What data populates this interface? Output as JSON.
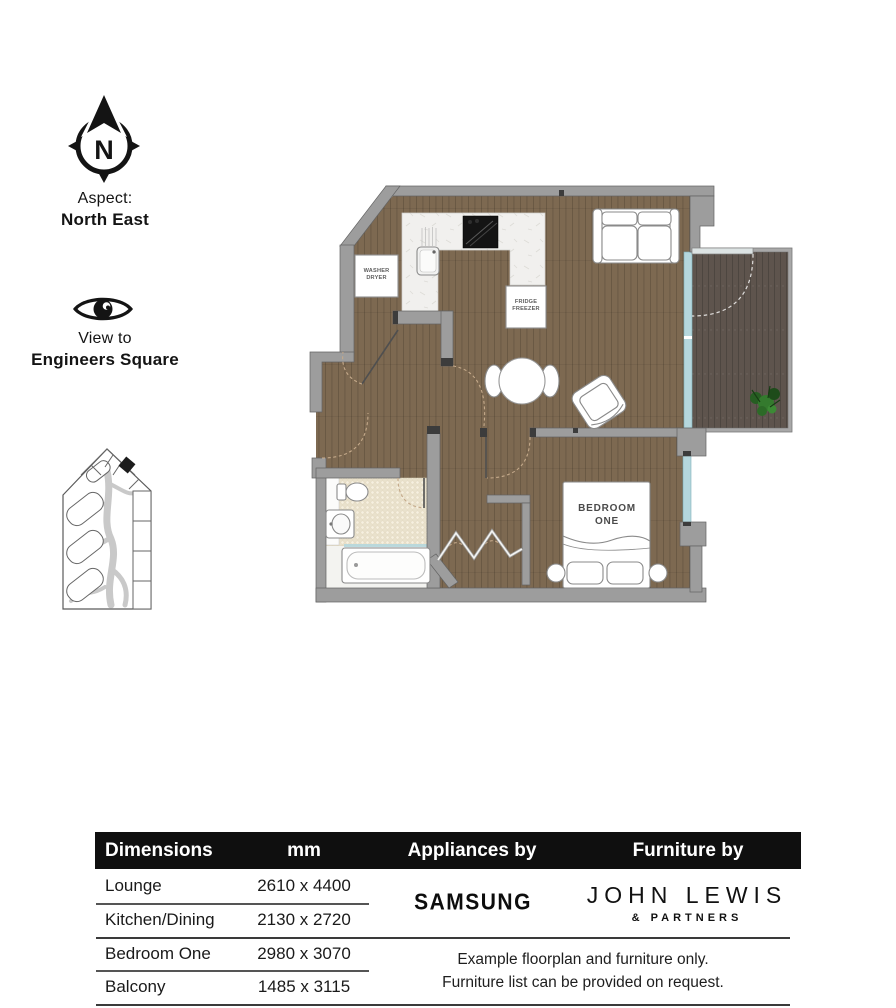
{
  "compass": {
    "north_letter": "N"
  },
  "aspect": {
    "label": "Aspect:",
    "value": "North East"
  },
  "view": {
    "label": "View to",
    "value": "Engineers Square"
  },
  "floorplan": {
    "washer": [
      "WASHER",
      "DRYER"
    ],
    "fridge": [
      "FRIDGE",
      "FREEZER"
    ],
    "bedroom": [
      "BEDROOM",
      "ONE"
    ]
  },
  "table": {
    "headers": [
      "Dimensions",
      "mm",
      "Appliances by",
      "Furniture by"
    ],
    "rows": [
      {
        "room": "Lounge",
        "size": "2610 x 4400"
      },
      {
        "room": "Kitchen/Dining",
        "size": "2130 x 2720"
      },
      {
        "room": "Bedroom One",
        "size": "2980 x 3070"
      },
      {
        "room": "Balcony",
        "size": "1485 x 3115"
      }
    ],
    "appliances_brand": "SAMSUNG",
    "furniture_brand": "JOHN LEWIS",
    "furniture_brand_sub": "& PARTNERS",
    "note_line1": "Example floorplan and furniture only.",
    "note_line2": "Furniture list can be provided on request."
  },
  "colors": {
    "wall": "#9d9d9d",
    "wood": "#7d6951",
    "deck": "#5e544d",
    "glass": "#b5d7dd",
    "tile": "#e9e1cc",
    "marble": "#f1f0ee",
    "header_bg": "#0f0f0f"
  }
}
